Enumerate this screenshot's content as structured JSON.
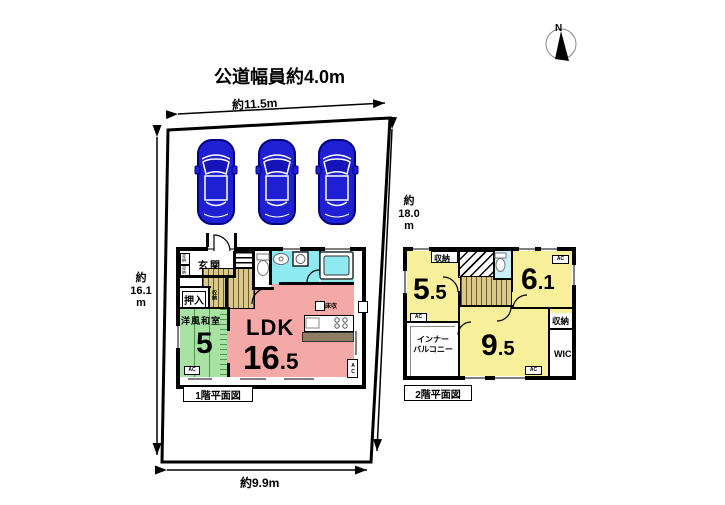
{
  "title": "公道幅員約4.0m",
  "compass": {
    "north": "N"
  },
  "dimensions": {
    "top": "約11.5m",
    "left": "約\n16.1\nm",
    "right": "約\n18.0\nm",
    "bottom": "約9.9m"
  },
  "floor1": {
    "caption": "1階平面図",
    "ac_label": "AC",
    "genkan": "玄関",
    "shoe_box1": "収納",
    "shoe_box2": "収納",
    "oshiire": "押入",
    "stair_closet": "収納",
    "washitsu": {
      "label": "洋風和室",
      "size": "5"
    },
    "ldk": {
      "label": "LDK",
      "size_main": "16",
      "size_frac": ".5",
      "floor_storage": "床収"
    }
  },
  "floor2": {
    "caption": "2階平面図",
    "ac_label": "AC",
    "closet_top": "収納",
    "closet_right": "収納",
    "wic": "WIC",
    "balcony": "インナー\nバルコニー",
    "room55": {
      "size_main": "5",
      "size_frac": ".5"
    },
    "room61": {
      "size_main": "6",
      "size_frac": ".1"
    },
    "room95": {
      "size_main": "9",
      "size_frac": ".5"
    }
  },
  "colors": {
    "ldk_pink": "#f4a9a6",
    "washitsu_green": "#a8e2a2",
    "floor2_yellow": "#f7ef9a",
    "bath_cyan": "#8ee9f0",
    "toilet_cyan": "#c9f0f7",
    "stairs_tan": "#dcc98a",
    "counter_brown": "#8d7d63",
    "car_blue": "#1f1fd4",
    "wall_black": "#000000"
  }
}
